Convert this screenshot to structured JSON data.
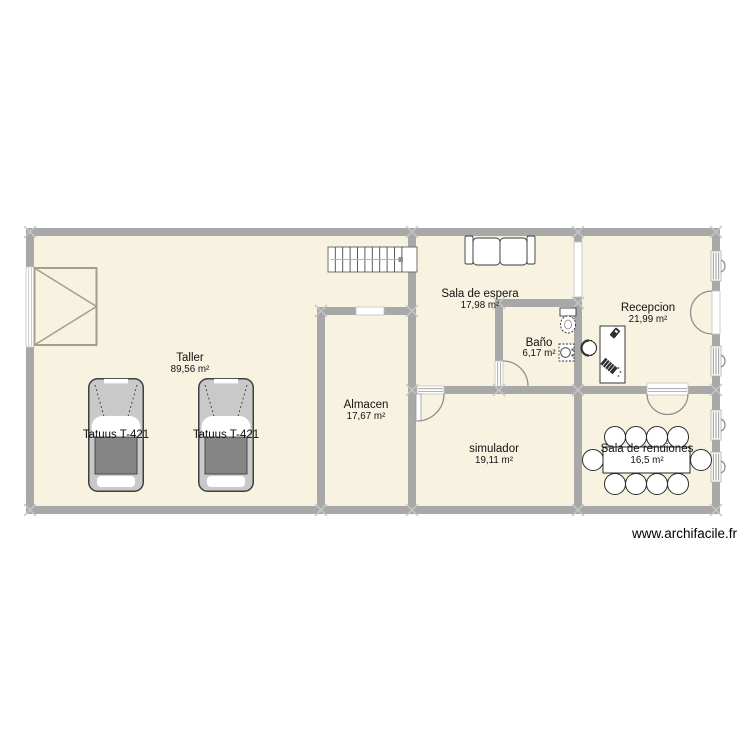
{
  "page": {
    "background_color": "#ffffff",
    "floor_color": "#f8f3e1",
    "wall_color": "#a8a8a8"
  },
  "plan": {
    "rooms": [
      {
        "name": "Taller",
        "area": "89,56 m²"
      },
      {
        "name": "Almacen",
        "area": "17,67 m²"
      },
      {
        "name": "Sala de espera",
        "area": "17,98 m²"
      },
      {
        "name": "Baño",
        "area": "6,17 m²"
      },
      {
        "name": "Recepcion",
        "area": "21,99 m²"
      },
      {
        "name": "simulador",
        "area": "19,11 m²"
      },
      {
        "name": "Sala de renuiones",
        "area": "16,5 m²"
      }
    ],
    "vehicles": [
      {
        "label": "Tatuus T-421"
      },
      {
        "label": "Tatuus T-421"
      }
    ],
    "furniture_icons": [
      "stairs-icon",
      "garage-door-icon",
      "sofa-icon",
      "toilet-icon",
      "sink-icon",
      "reception-desk-icon",
      "office-chair-icon",
      "meeting-table-icon",
      "chair-icon",
      "car-icon",
      "window-icon",
      "door-arc-icon"
    ]
  },
  "watermark": {
    "text": "www.archifacile.fr"
  }
}
